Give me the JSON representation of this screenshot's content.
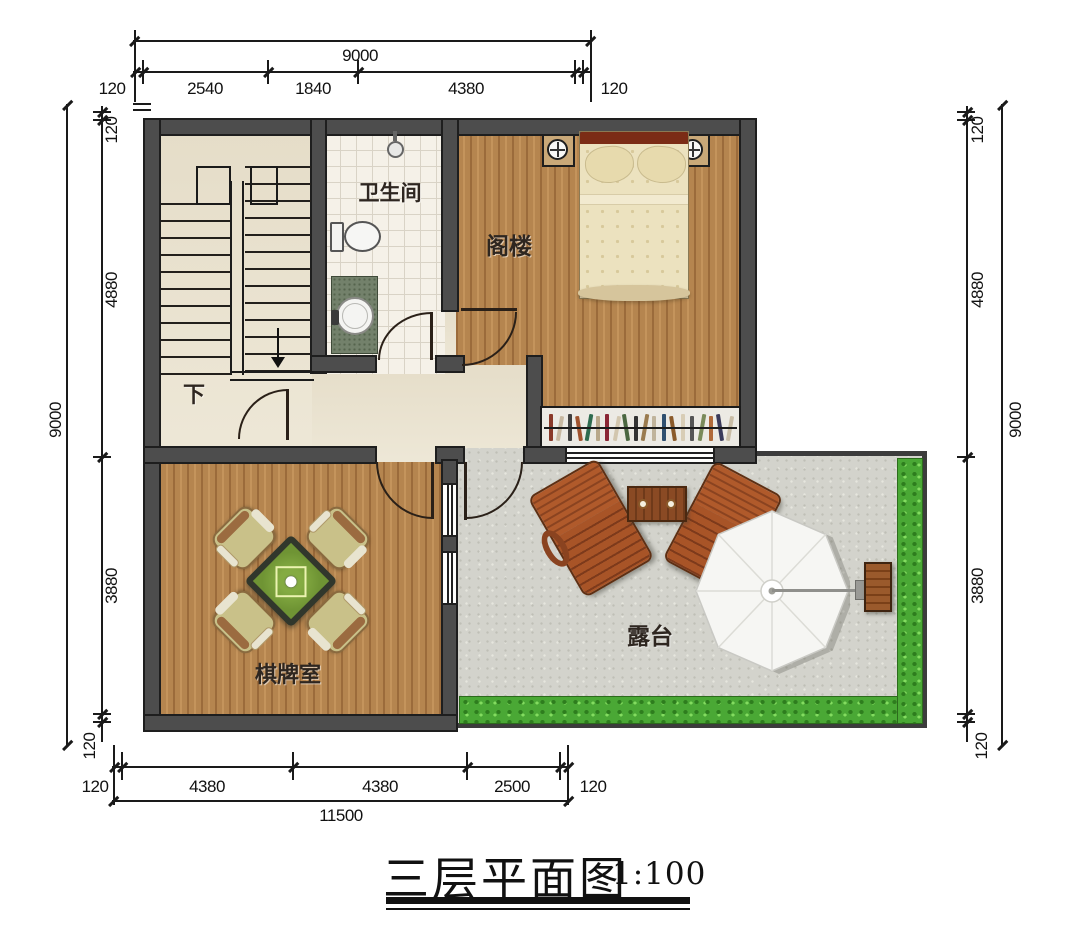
{
  "title": {
    "text": "三层平面图",
    "scale": "1:100"
  },
  "rooms": {
    "stairs_down": "下",
    "bathroom": "卫生间",
    "attic": "阁楼",
    "chess_room": "棋牌室",
    "terrace": "露台"
  },
  "dims": {
    "top": {
      "overall": "9000",
      "labels": [
        "120",
        "2540",
        "1840",
        "4380",
        "120"
      ]
    },
    "bottom": {
      "overall": "11500",
      "labels": [
        "120",
        "4380",
        "4380",
        "2500",
        "120"
      ]
    },
    "left": {
      "overall": "9000",
      "labels": [
        "120",
        "4880",
        "3880",
        "120"
      ]
    },
    "right": {
      "overall": "9000",
      "labels": [
        "120",
        "4880",
        "3880",
        "120"
      ]
    }
  },
  "colors": {
    "wall": "#4d4d4d",
    "wood_floor": "#b5854f",
    "cream_floor": "#ebe4d1",
    "tile_floor": "#f5f1e8",
    "terrace_floor": "#d3d3cc",
    "hedge_green": "#4aa835",
    "mahjong_felt": "#6f9434",
    "headboard": "#7b2c16",
    "line_ink": "#1a1a1a"
  },
  "furniture": {
    "bookshelf_books": [
      "#8a3a2a",
      "#c8b9a2",
      "#3f3f3f",
      "#a0522d",
      "#2e6b4f",
      "#b8a88a",
      "#8b2635",
      "#d2c6ae",
      "#4a6741",
      "#333333",
      "#9a7b4f",
      "#c0b49c",
      "#2f4f6f",
      "#8a5a2a",
      "#d8cdb6",
      "#555555",
      "#7a8a5a",
      "#b06a3a",
      "#3a3a5a",
      "#c9bda6"
    ]
  }
}
